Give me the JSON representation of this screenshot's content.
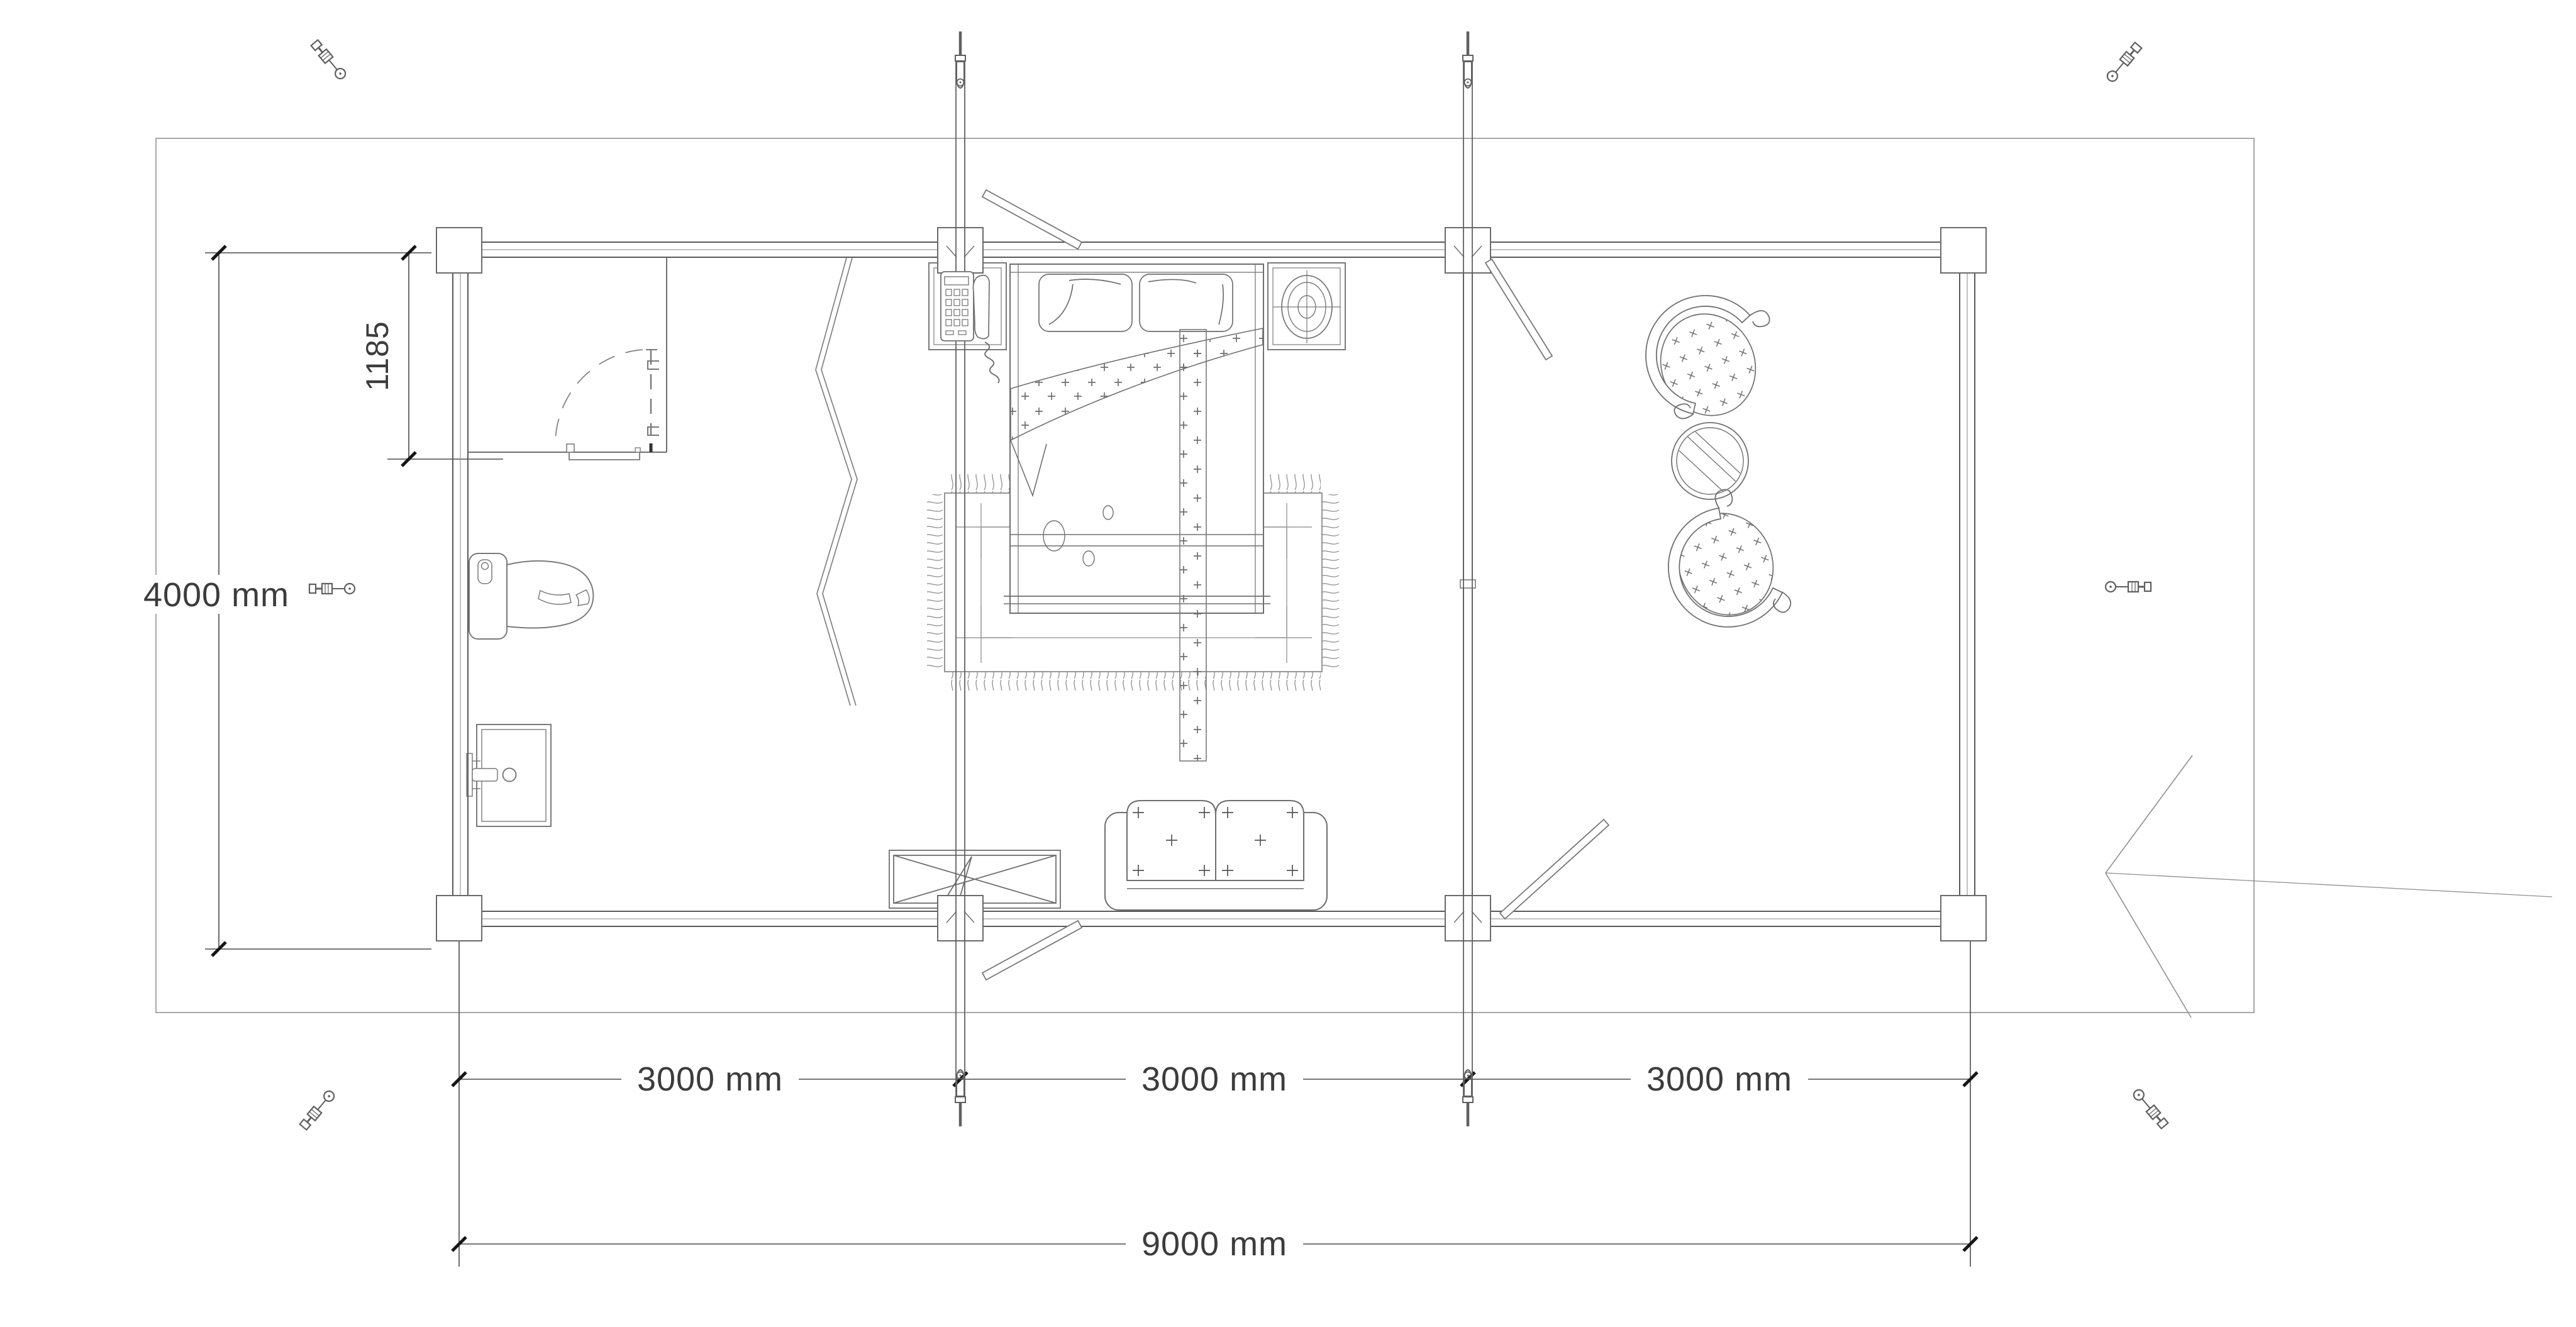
{
  "drawing": {
    "type": "floor-plan",
    "background": "#ffffff"
  },
  "colors": {
    "boundary_line": "#a8a8a8",
    "wall_line": "#5a5a5a",
    "wall_mid_line": "#9a9a9a",
    "furniture_line": "#7a7a7a",
    "dimension_line": "#4a4a4a",
    "tick": "#161616",
    "text": "#3c3c3c",
    "arrow": "#8f8f8f"
  },
  "dimensions": {
    "offset": {
      "label": "1185"
    },
    "height": {
      "label": "4000 mm"
    },
    "segments": [
      {
        "label": "3000 mm"
      },
      {
        "label": "3000 mm"
      },
      {
        "label": "3000 mm"
      }
    ],
    "total": {
      "label": "9000 mm"
    }
  },
  "icons": {
    "eyebolt": "eye-bolt-fastener",
    "turnbuckle": "tie-rod-turnbuckle",
    "entrance_arrow": "entrance-direction-arrow"
  }
}
